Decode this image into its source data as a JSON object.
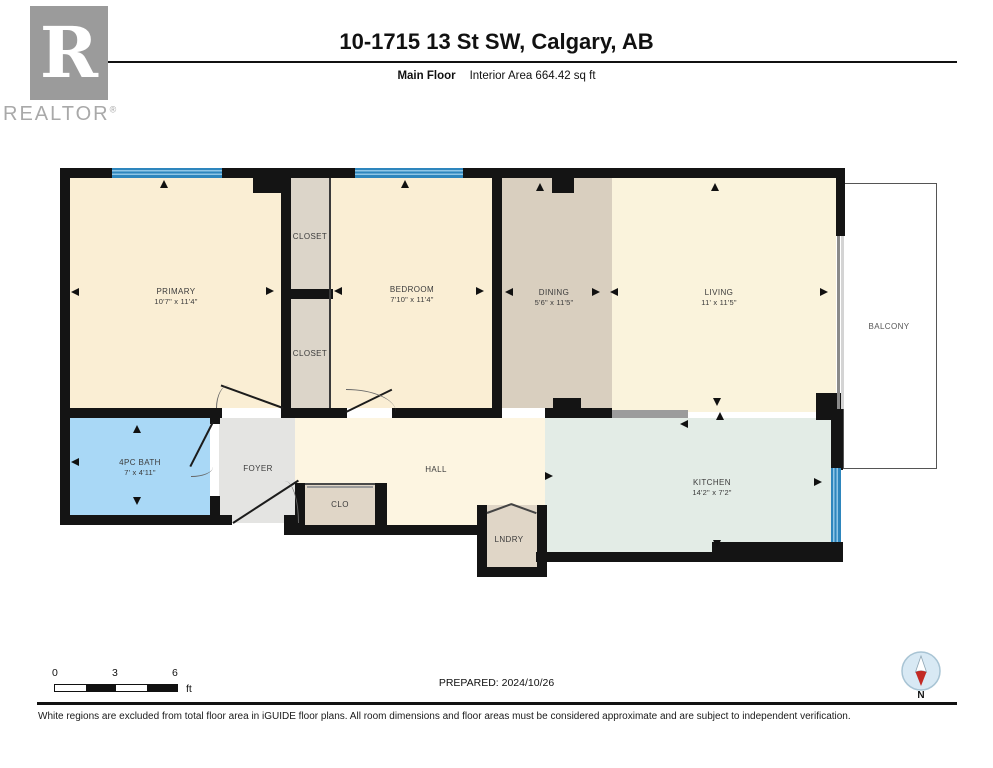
{
  "header": {
    "logo_r": "R",
    "logo_text": "REALTOR",
    "logo_registered": "®",
    "title": "10-1715 13 St SW, Calgary, AB",
    "floor_label": "Main Floor",
    "area_label": "Interior Area 664.42 sq ft"
  },
  "rooms": [
    {
      "name": "PRIMARY",
      "dims": "10'7\" x 11'4\""
    },
    {
      "name": "CLOSET",
      "dims": ""
    },
    {
      "name": "CLOSET",
      "dims": ""
    },
    {
      "name": "BEDROOM",
      "dims": "7'10\" x 11'4\""
    },
    {
      "name": "DINING",
      "dims": "5'6\" x 11'5\""
    },
    {
      "name": "LIVING",
      "dims": "11' x 11'5\""
    },
    {
      "name": "BALCONY",
      "dims": ""
    },
    {
      "name": "4PC BATH",
      "dims": "7' x 4'11\""
    },
    {
      "name": "FOYER",
      "dims": ""
    },
    {
      "name": "HALL",
      "dims": ""
    },
    {
      "name": "CLO",
      "dims": ""
    },
    {
      "name": "LNDRY",
      "dims": ""
    },
    {
      "name": "KITCHEN",
      "dims": "14'2\" x 7'2\""
    }
  ],
  "footer": {
    "scale_ticks": [
      "0",
      "3",
      "6"
    ],
    "scale_unit": "ft",
    "prepared": "PREPARED: 2024/10/26",
    "compass_label": "N",
    "disclaimer": "White regions are excluded from total floor area in iGUIDE floor plans. All room dimensions and floor areas must be considered approximate and are subject to independent verification."
  },
  "colors": {
    "wall": "#141414",
    "window_blue": "#2e86bd",
    "cream_room": "#faeed4",
    "living_room": "#faf3dc",
    "hall_room": "#fdf5e1",
    "dining_room": "#d9cfbf",
    "closet_room": "#dcd5c9",
    "tan_room": "#e0d6c7",
    "bath_blue": "#a9d8f6",
    "kitchen_mint": "#e3ece6",
    "foyer_gray": "#e4e4e2",
    "compass_red": "#c22a24"
  }
}
